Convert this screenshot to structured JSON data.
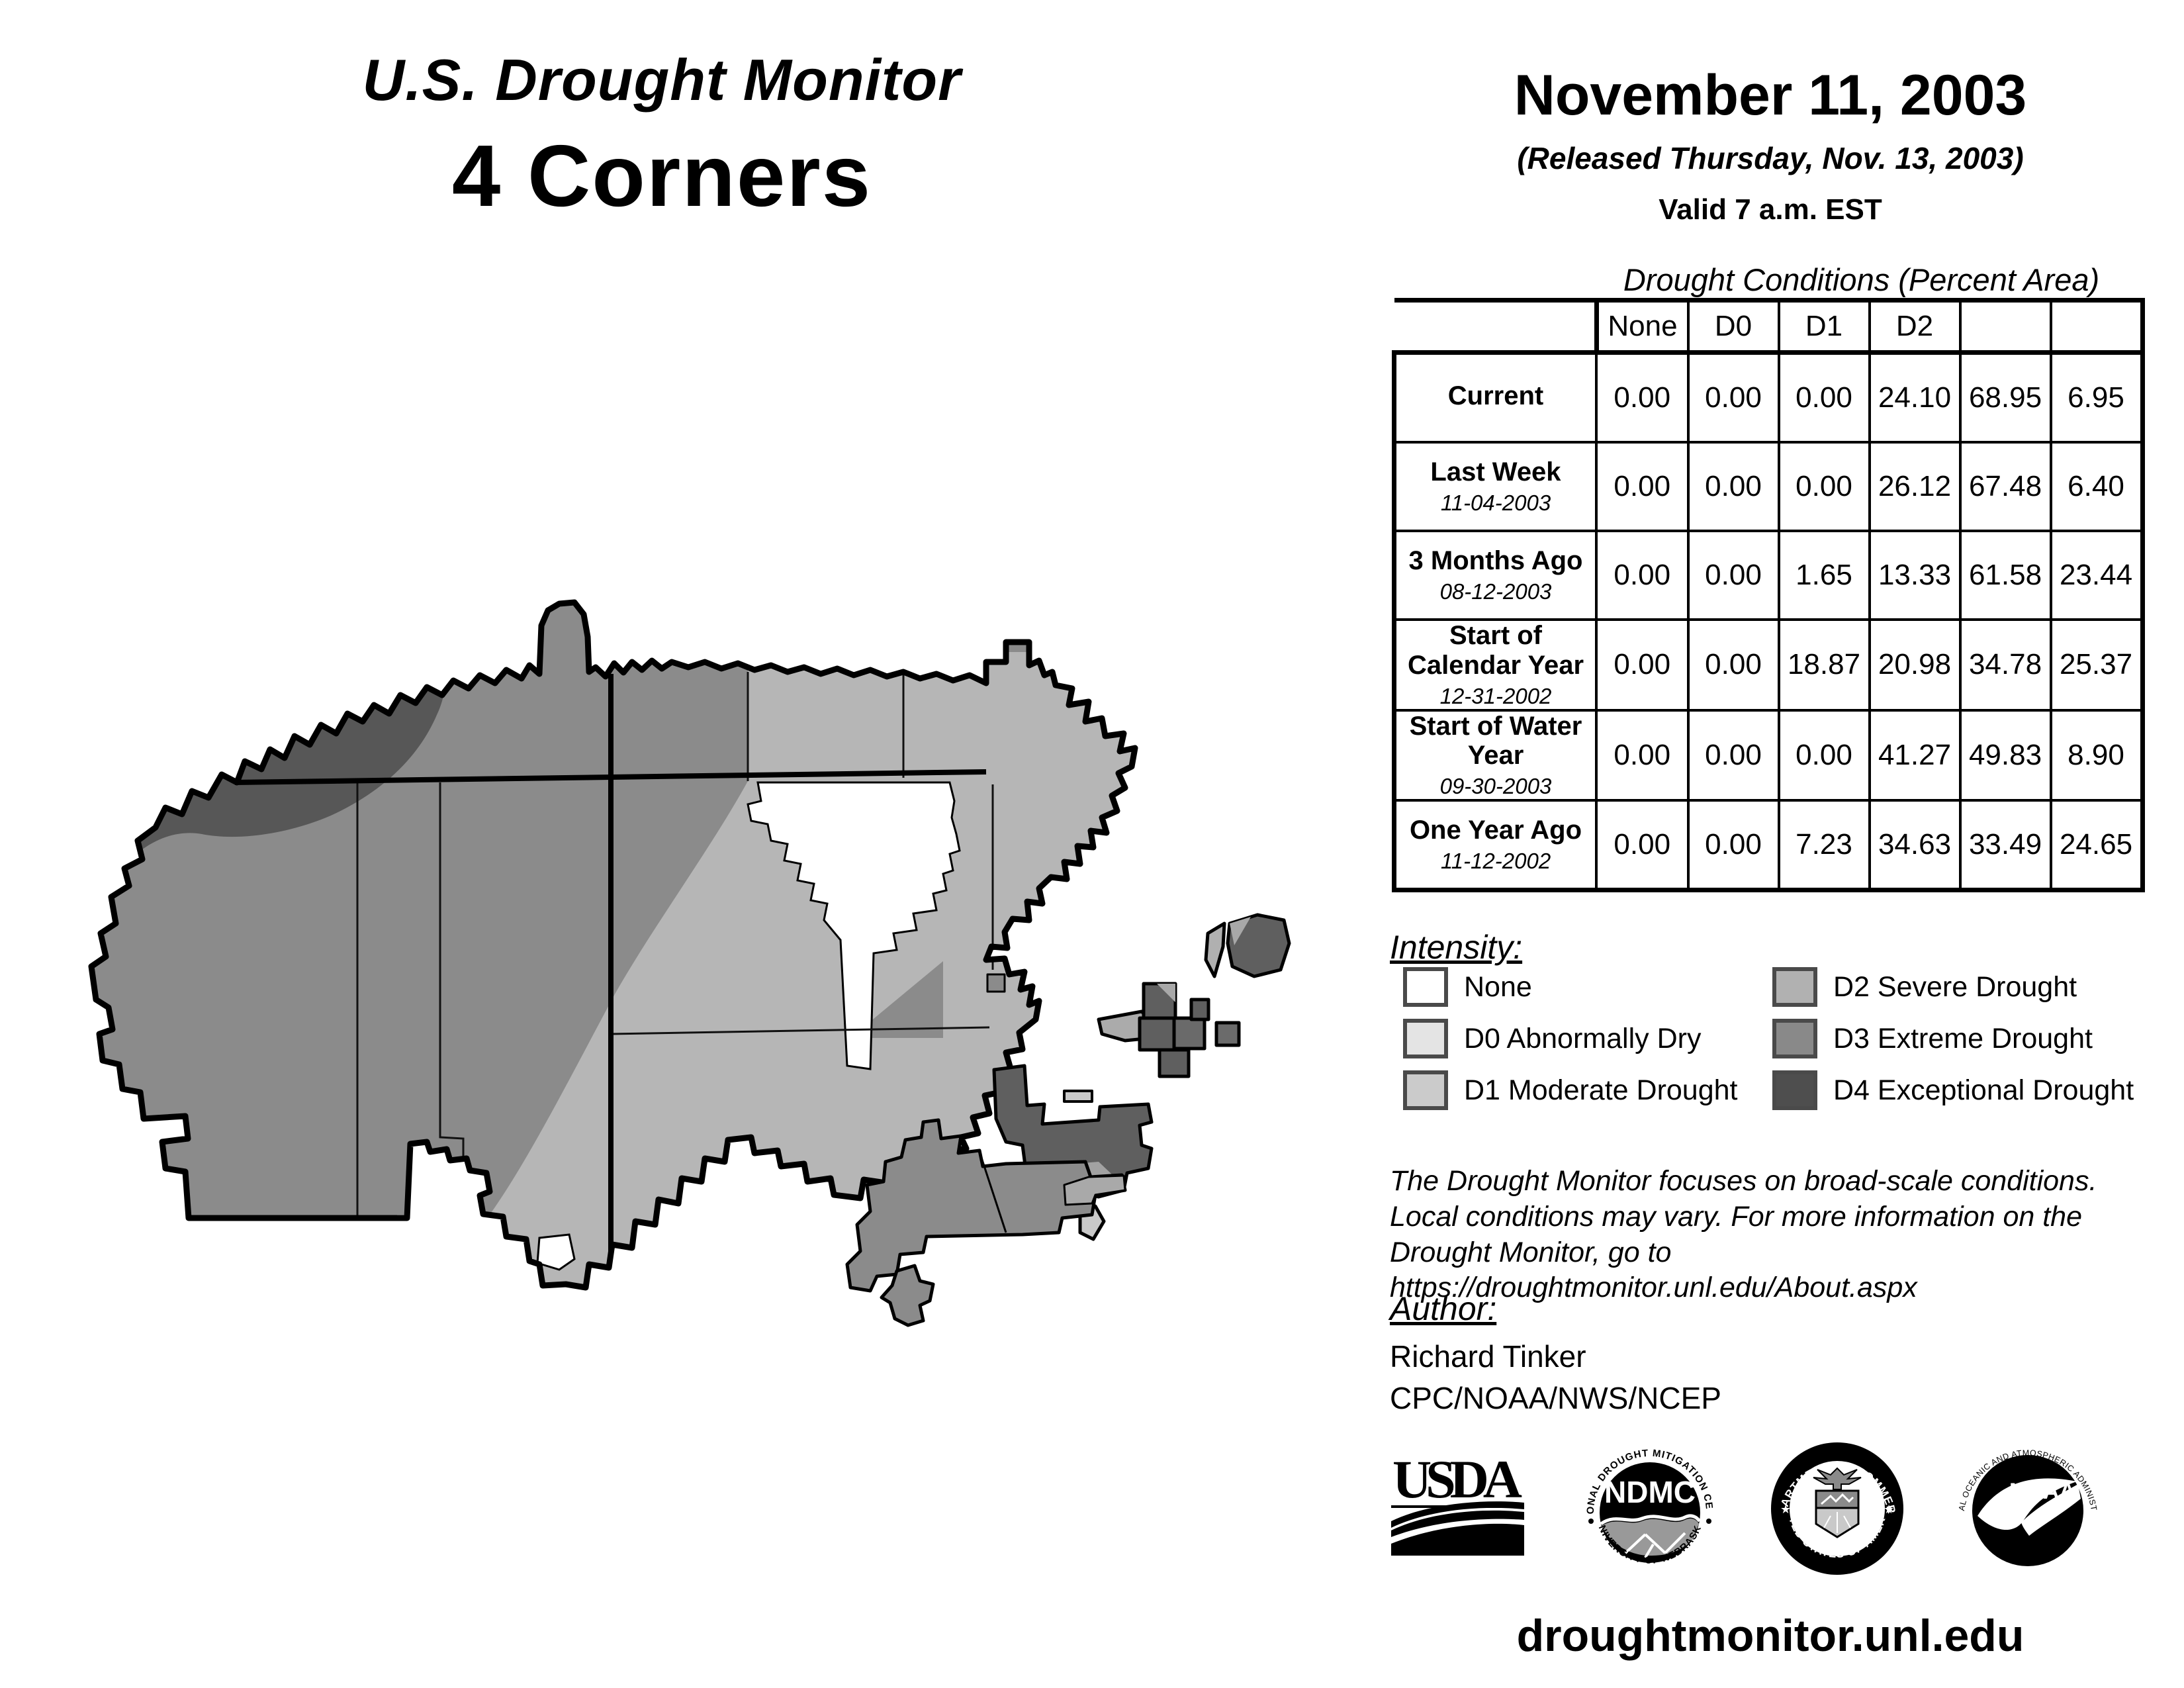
{
  "header": {
    "title": "U.S. Drought Monitor",
    "region": "4 Corners",
    "date": "November 11, 2003",
    "released": "(Released Thursday, Nov. 13, 2003)",
    "valid": "Valid 7 a.m. EST"
  },
  "table": {
    "title": "Drought Conditions (Percent Area)",
    "columns": [
      "None",
      "D0",
      "D1",
      "D2",
      "D3",
      "D4"
    ],
    "rows": [
      {
        "label": "Current",
        "date": "",
        "values": [
          "0.00",
          "0.00",
          "0.00",
          "24.10",
          "68.95",
          "6.95"
        ]
      },
      {
        "label": "Last Week",
        "date": "11-04-2003",
        "values": [
          "0.00",
          "0.00",
          "0.00",
          "26.12",
          "67.48",
          "6.40"
        ]
      },
      {
        "label": "3 Months Ago",
        "date": "08-12-2003",
        "values": [
          "0.00",
          "0.00",
          "1.65",
          "13.33",
          "61.58",
          "23.44"
        ]
      },
      {
        "label": "Start of Calendar Year",
        "date": "12-31-2002",
        "values": [
          "0.00",
          "0.00",
          "18.87",
          "20.98",
          "34.78",
          "25.37"
        ]
      },
      {
        "label": "Start of Water Year",
        "date": "09-30-2003",
        "values": [
          "0.00",
          "0.00",
          "0.00",
          "41.27",
          "49.83",
          "8.90"
        ]
      },
      {
        "label": "One Year Ago",
        "date": "11-12-2002",
        "values": [
          "0.00",
          "0.00",
          "7.23",
          "34.63",
          "33.49",
          "24.65"
        ]
      }
    ]
  },
  "legend": {
    "heading": "Intensity:",
    "items": [
      {
        "key": "none",
        "label": "None"
      },
      {
        "key": "d0",
        "label": "D0 Abnormally Dry"
      },
      {
        "key": "d1",
        "label": "D1 Moderate Drought"
      },
      {
        "key": "d2",
        "label": "D2 Severe Drought"
      },
      {
        "key": "d3",
        "label": "D3 Extreme Drought"
      },
      {
        "key": "d4",
        "label": "D4 Exceptional Drought"
      }
    ]
  },
  "notes": {
    "line1": "The Drought Monitor focuses on broad-scale conditions.",
    "line2": "Local conditions may vary. For more information on the",
    "line3": "Drought Monitor, go to https://droughtmonitor.unl.edu/About.aspx"
  },
  "author": {
    "heading": "Author:",
    "name": "Richard Tinker",
    "org": "CPC/NOAA/NWS/NCEP"
  },
  "logos": {
    "usda": {
      "text": "USDA"
    },
    "ndmc": {
      "center": "NDMC",
      "top": "NATIONAL DROUGHT MITIGATION CENTER",
      "bottom": "UNIVERSITY OF NEBRASKA"
    },
    "doc": {
      "top": "DEPARTMENT OF COMMERCE",
      "bottom": "UNITED STATES OF AMERICA"
    },
    "noaa": {
      "center": "NOAA",
      "top": "NATIONAL OCEANIC AND ATMOSPHERIC ADMINISTRATION",
      "bottom": "U.S. DEPARTMENT OF COMMERCE"
    }
  },
  "footer_url": "droughtmonitor.unl.edu",
  "colors": {
    "none": "#ffffff",
    "d0": "#e4e4e4",
    "d1": "#cbcbcb",
    "d2": "#b1b1b1",
    "d3": "#898989",
    "d4": "#4e4e4e",
    "map-d2": "#b6b6b6",
    "map-d3": "#8b8b8b",
    "map-d4": "#575757",
    "outline": "#000000"
  }
}
